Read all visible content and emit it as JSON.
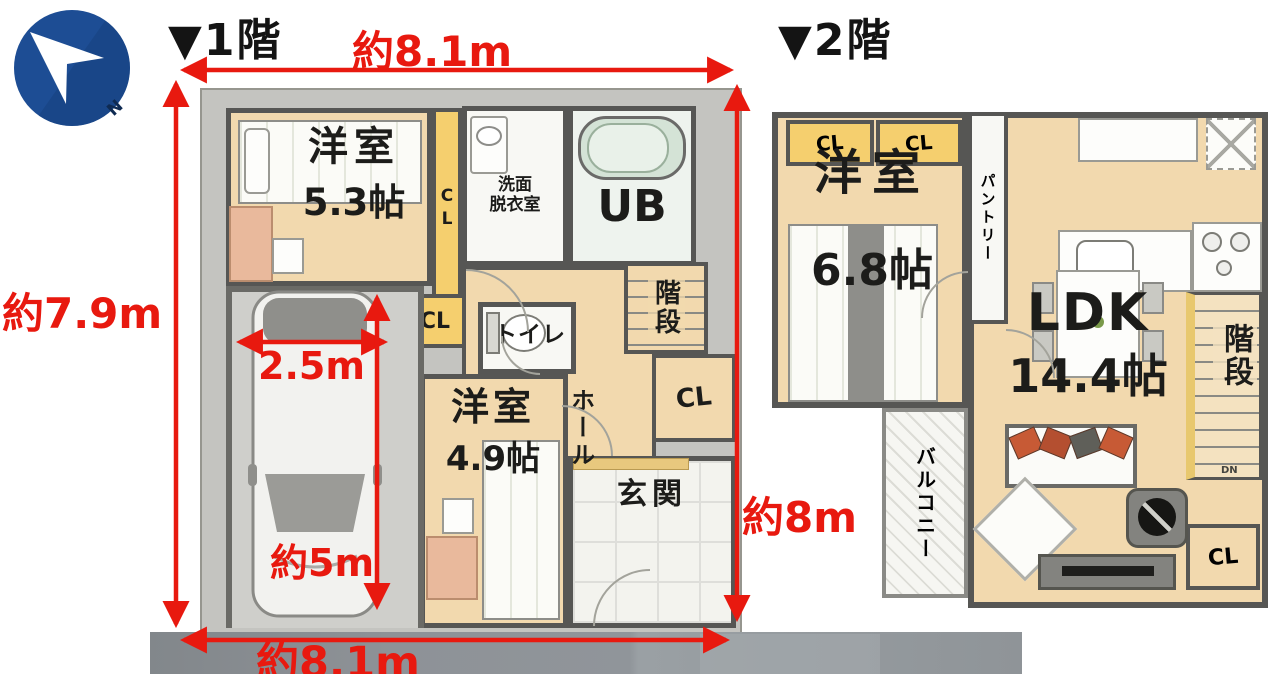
{
  "compass": {
    "north": "N"
  },
  "floor1": {
    "label": "▼1階",
    "rooms": {
      "bedroom1_name": "洋室",
      "bedroom1_size": "5.3帖",
      "closet_top": "CL",
      "washroom_line1": "洗面",
      "washroom_line2": "脱衣室",
      "bath": "UB",
      "stairs": "階段",
      "closet_stairs": "CL",
      "toilet": "トイレ",
      "closet_hall": "CL",
      "hall": "ホール",
      "bedroom2_name": "洋室",
      "bedroom2_size": "4.9帖",
      "entrance": "玄関"
    },
    "dims": {
      "top": "約8.1m",
      "left": "約7.9m",
      "bottom": "約8.1m",
      "right": "約8m",
      "car_width": "2.5m",
      "car_length": "約5m"
    }
  },
  "floor2": {
    "label": "▼2階",
    "rooms": {
      "closet_a": "CL",
      "closet_b": "CL",
      "pantry": "パントリー",
      "bedroom_name": "洋室",
      "bedroom_size": "6.8帖",
      "ldk_name": "LDK",
      "ldk_size": "14.4帖",
      "stairs": "階段",
      "stairs_dn": "DN",
      "balcony": "バルコニー",
      "closet_c": "CL"
    }
  },
  "colors": {
    "dimension_red": "#e8190f",
    "floor_tan": "#f2d9ae",
    "closet_yellow": "#f5cf6e",
    "wall_gray": "#565654",
    "concrete_gray": "#c4c4c0",
    "compass_blue": "#1d4d94",
    "road_gray": "#8e9297"
  }
}
